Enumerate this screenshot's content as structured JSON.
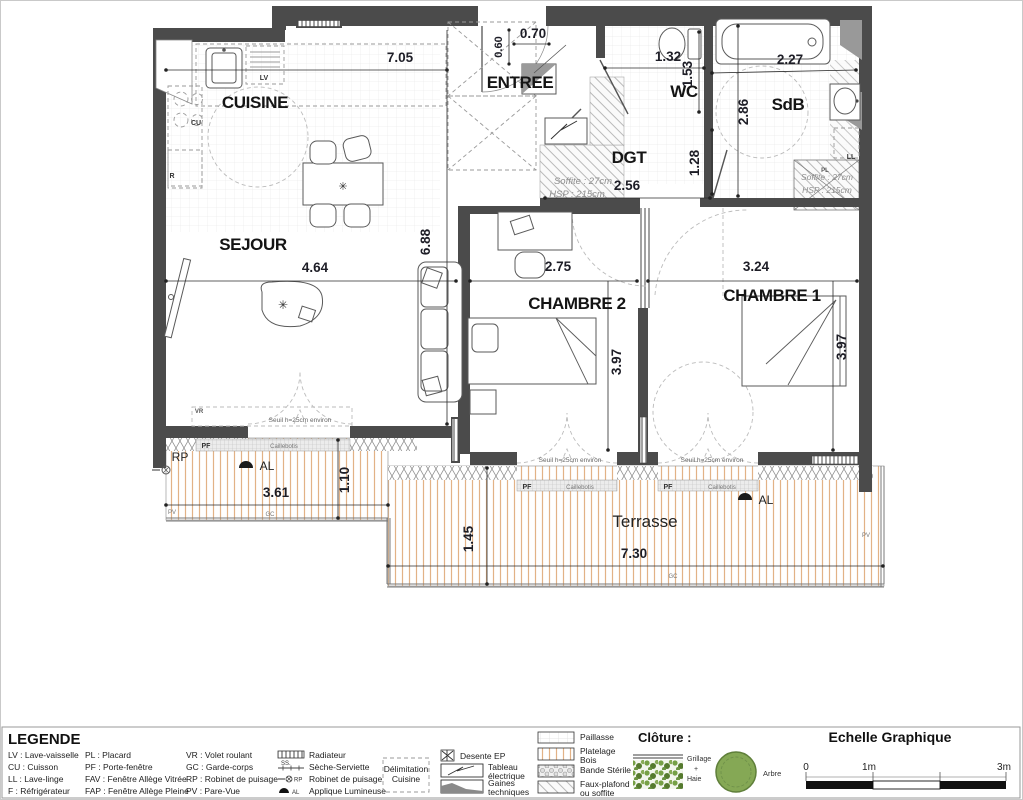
{
  "plan": {
    "rooms": {
      "cuisine": "CUISINE",
      "sejour": "SEJOUR",
      "entree": "ENTREE",
      "wc": "WC",
      "sdb": "SdB",
      "dgt": "DGT",
      "chambre2": "CHAMBRE 2",
      "chambre1": "CHAMBRE 1",
      "terrasse": "Terrasse"
    },
    "dims": {
      "top_width": "7.05",
      "entree_d1": "0.60",
      "entree_d2": "0.70",
      "wc_w": "1.32",
      "wc_h": "1.53",
      "sdb_w": "2.27",
      "sdb_h": "2.86",
      "dgt_h": "1.28",
      "dgt_w": "2.56",
      "sejour_h": "6.88",
      "sejour_w": "4.64",
      "ch2_w": "2.75",
      "ch1_w": "3.24",
      "ch2_h": "3.97",
      "ch1_h": "3.97",
      "terr_left_w": "3.61",
      "terr_left_h": "1.10",
      "terr_h": "1.45",
      "terr_w": "7.30"
    },
    "tags": {
      "lv": "LV",
      "cu": "CU",
      "fridge": "R",
      "ll": "LL",
      "pl": "PL",
      "vr": "VR",
      "pf": "PF",
      "pv": "PV",
      "gc": "GC",
      "rp": "RP",
      "al": "AL"
    },
    "notes": {
      "caillebotis": "Caillebotis",
      "seuil": "Seuil h=25cm environ",
      "soffite": "Soffite : 27cm",
      "hsp": "HSP : 215cm"
    },
    "colors": {
      "wall": "#4b4b4b",
      "deck_line": "#e2b286",
      "green": "#76a046"
    }
  },
  "legend": {
    "title": "LEGENDE",
    "abbr1": [
      "LV : Lave-vaisselle",
      "CU : Cuisson",
      "LL : Lave-linge",
      "F : Réfrigérateur"
    ],
    "abbr2": [
      "PL : Placard",
      "PF : Porte-fenêtre",
      "FAV : Fenêtre Allège Vitrée",
      "FAP : Fenêtre Allège Pleine"
    ],
    "abbr3": [
      "VR : Volet roulant",
      "GC : Garde-corps",
      "RP : Robinet de puisage",
      "PV : Pare-Vue"
    ],
    "icons1": [
      "Radiateur",
      "Sèche-Serviette",
      "Robinet de puisage",
      "Applique Lumineuse"
    ],
    "ss_tag": "SS.",
    "rp_tag": "RP",
    "al_tag": "AL",
    "delim1": "Délimitation",
    "delim2": "Cuisine",
    "desente": "Desente EP",
    "tableau1": "Tableau",
    "tableau2": "électrique",
    "gaines1": "Gaines",
    "gaines2": "techniques",
    "paillasse": "Paillasse",
    "platelage1": "Platelage",
    "platelage2": "Bois",
    "bande": "Bande Stérile",
    "faux1": "Faux-plafond",
    "faux2": "ou soffite",
    "cloture": "Clôture :",
    "grillage": "Grillage",
    "plus": "+",
    "haie": "Haie",
    "arbre": "Arbre",
    "echelle": "Echelle Graphique",
    "s0": "0",
    "s1": "1m",
    "s3": "3m"
  }
}
